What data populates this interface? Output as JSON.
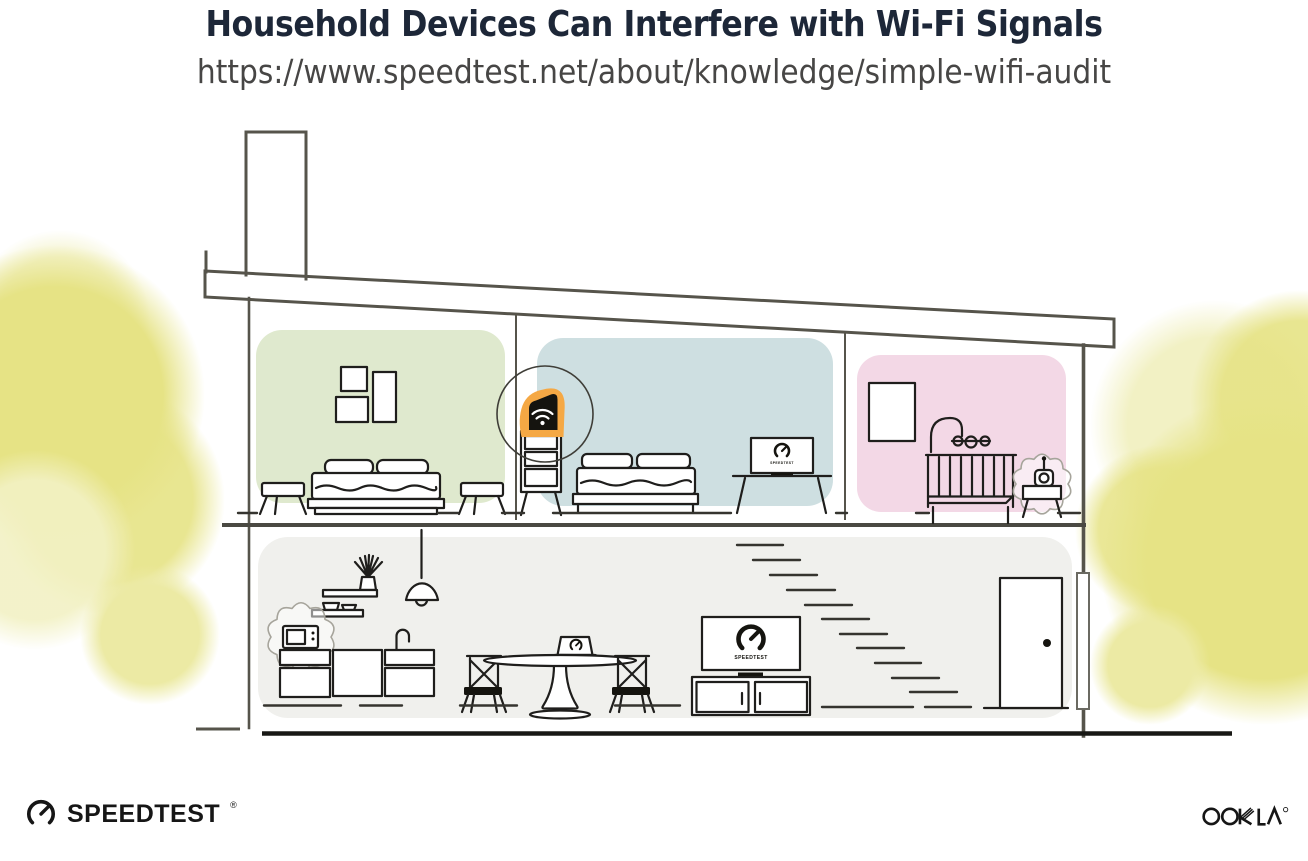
{
  "header": {
    "title": "Household Devices Can Interfere with Wi-Fi Signals",
    "url": "https://www.speedtest.net/about/knowledge/simple-wifi-audit"
  },
  "footer": {
    "speedtest_wordmark": "SPEEDTEST",
    "registered_mark": "®",
    "ookla_wordmark": "OOKLA"
  },
  "illustration": {
    "screen_brand_label": "SPEEDTEST",
    "highlight_color": "#F5A844",
    "room_colors": {
      "bedroom_left": "#DFE9CE",
      "bedroom_center": "#CEDFE1",
      "nursery": "#F3D8E6",
      "downstairs": "#F0F0ED"
    },
    "tree_color": "#E7E48A",
    "highlighted_device": "wifi-router",
    "interference_devices": [
      "microwave",
      "baby-monitor"
    ],
    "speedtest_screens": [
      "bedroom-tv",
      "living-room-tv",
      "dining-laptop"
    ]
  }
}
